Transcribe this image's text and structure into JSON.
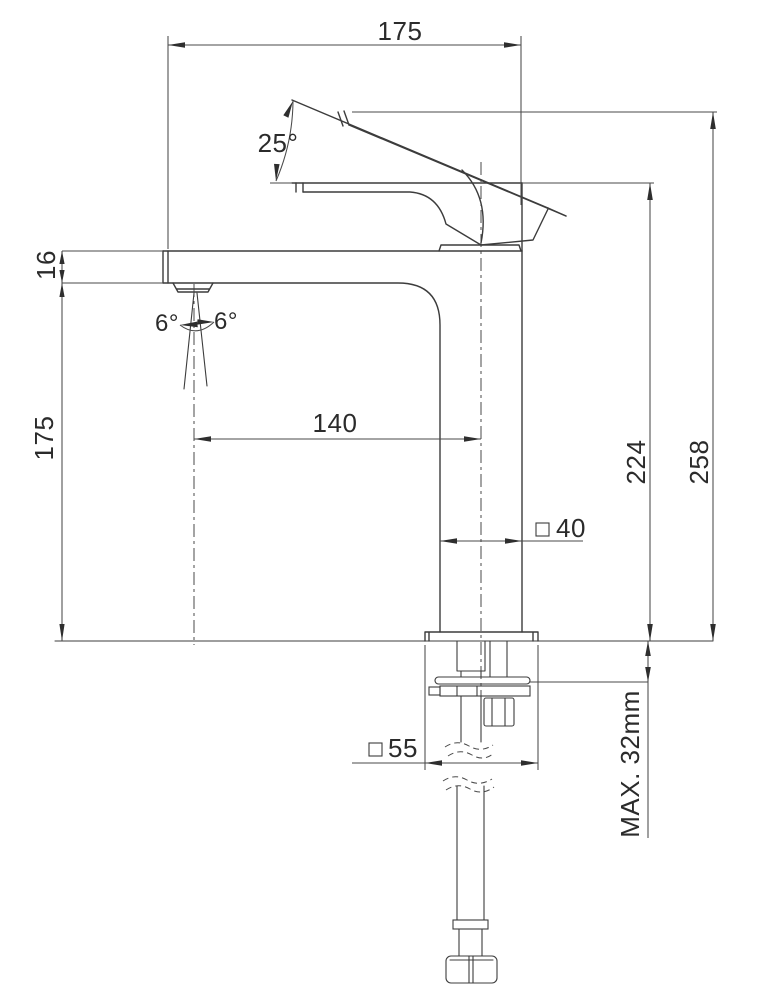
{
  "dims": {
    "top_width": "175",
    "lever_angle": "25°",
    "spout_thickness": "16",
    "spray_angle_left": "6°",
    "spray_angle_right": "6°",
    "spout_height": "175",
    "spout_reach": "140",
    "height_to_body_top": "224",
    "overall_height": "258",
    "body_width": "40",
    "base_width": "55",
    "max_bench_thickness": "MAX. 32mm"
  }
}
